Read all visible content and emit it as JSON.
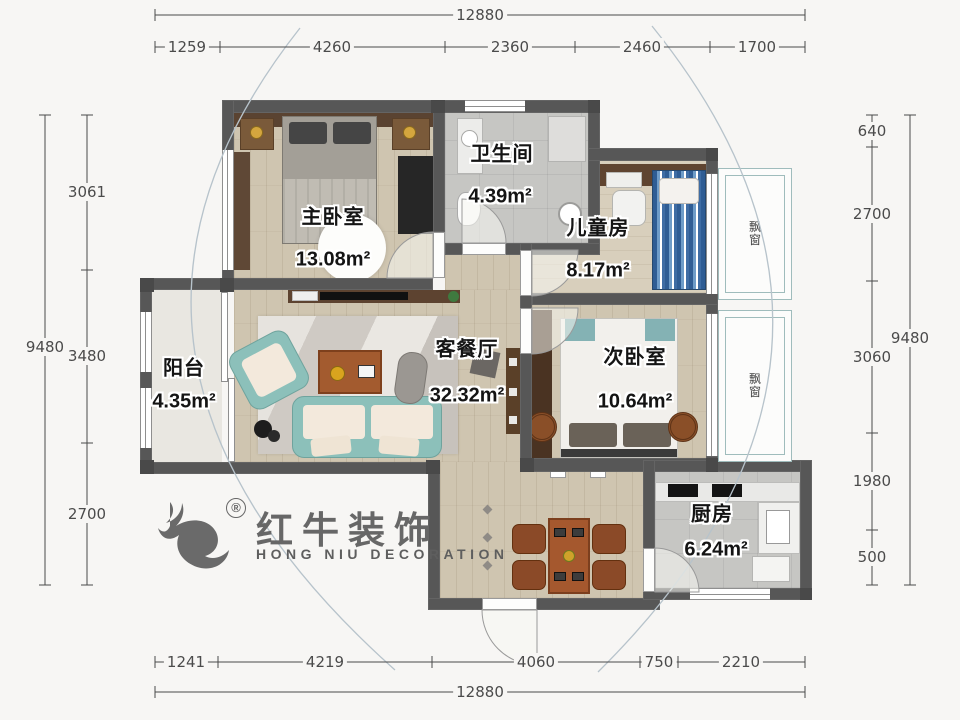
{
  "rooms": {
    "master": {
      "name": "主卧室",
      "area": "13.08m²"
    },
    "bath": {
      "name": "卫生间",
      "area": "4.39m²"
    },
    "kids": {
      "name": "儿童房",
      "area": "8.17m²"
    },
    "living": {
      "name": "客餐厅",
      "area": "32.32m²"
    },
    "second": {
      "name": "次卧室",
      "area": "10.64m²"
    },
    "balcony": {
      "name": "阳台",
      "area": "4.35m²"
    },
    "kitchen": {
      "name": "厨房",
      "area": "6.24m²"
    }
  },
  "bay": {
    "label": "飘窗"
  },
  "dims": {
    "top": {
      "total": "12880",
      "segments": [
        "1259",
        "4260",
        "2360",
        "2460",
        "1700"
      ]
    },
    "bottom": {
      "total": "12880",
      "segments": [
        "1241",
        "4219",
        "4060",
        "750",
        "2210"
      ]
    },
    "left": {
      "total": "9480",
      "segments": [
        "3061",
        "3480",
        "2700"
      ]
    },
    "right": {
      "total": "9480",
      "segments": [
        "640",
        "2700",
        "3060",
        "1980",
        "500"
      ]
    }
  },
  "logo": {
    "reg": "®",
    "cn": "红牛装饰",
    "en": "HONG NIU DECORATION"
  },
  "colors": {
    "wall": "#575757",
    "wood_floor": "#cfc5b0",
    "sofa_teal": "#8cc0ba",
    "bay_frame": "#9fbcbc",
    "kid_bed_blue": "#2f5d94"
  }
}
